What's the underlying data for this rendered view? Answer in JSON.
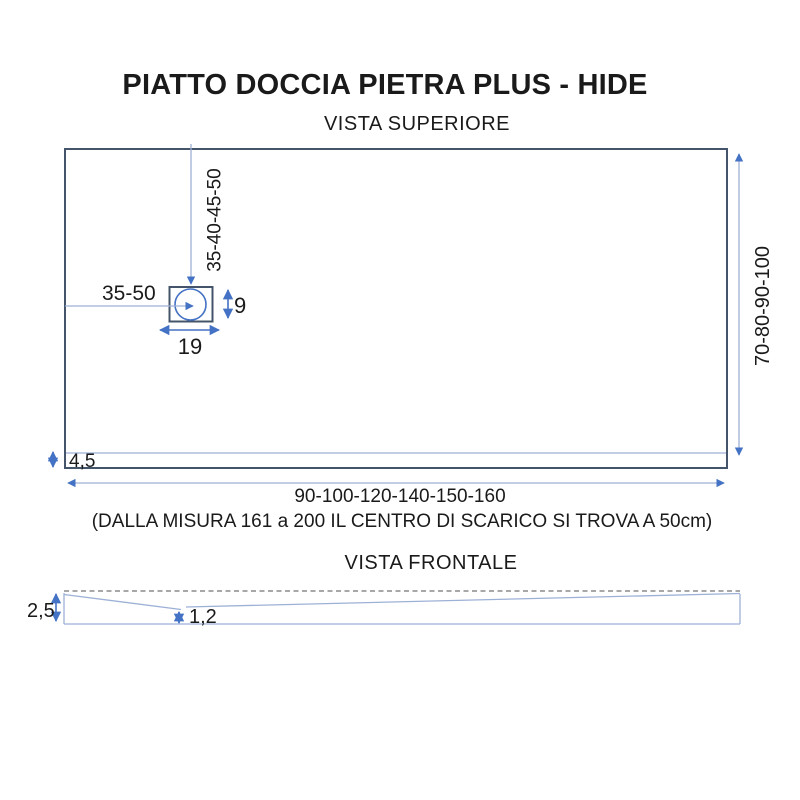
{
  "title": "PIATTO DOCCIA PIETRA PLUS - HIDE",
  "colors": {
    "outline_dark": "#44546A",
    "dimension_blue": "#4472C4",
    "line_light_blue": "#9DB1D6",
    "dashed_gray": "#8C8C8C",
    "text": "#1A1A1A"
  },
  "top_view": {
    "heading": "VISTA SUPERIORE",
    "labels": {
      "drain_offset_x": "35-50",
      "drain_offset_y": "35-40-45-50",
      "drain_width": "19",
      "drain_height": "9",
      "border_thickness": "4,5",
      "tray_depths": "70-80-90-100",
      "tray_widths": "90-100-120-140-150-160",
      "note": "(DALLA MISURA 161 a 200 IL CENTRO DI SCARICO SI TROVA A 50cm)"
    }
  },
  "front_view": {
    "heading": "VISTA FRONTALE",
    "labels": {
      "edge_height": "2,5",
      "center_height": "1,2"
    }
  }
}
